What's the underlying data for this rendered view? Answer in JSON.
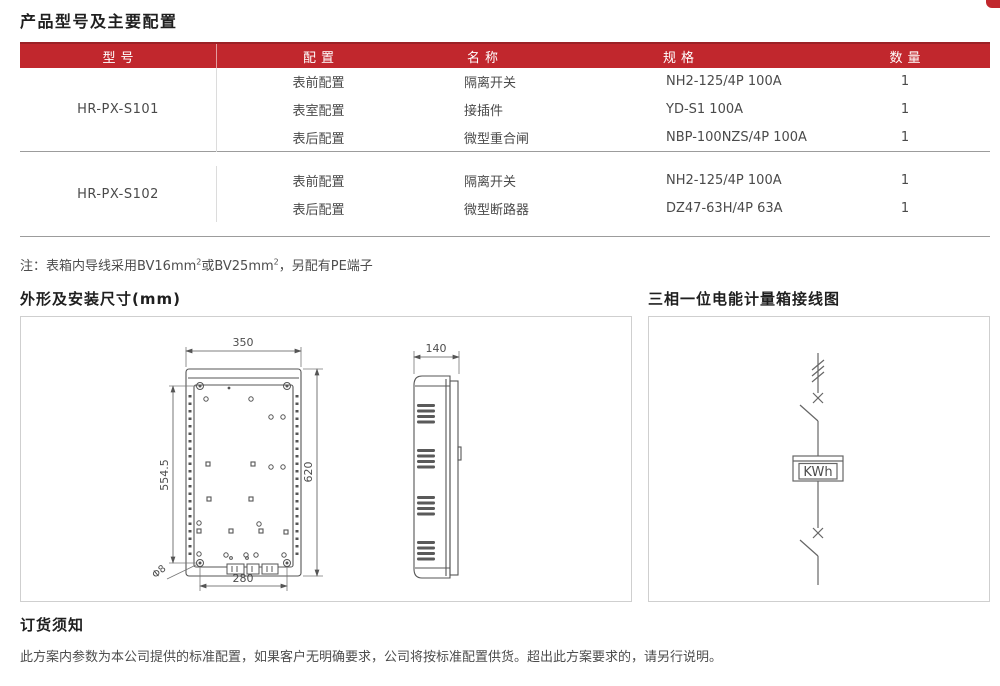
{
  "page": {
    "title": "产品型号及主要配置",
    "accent_color": "#c1272d"
  },
  "table": {
    "headers": [
      "型号",
      "配置",
      "名称",
      "规格",
      "数量"
    ],
    "groups": [
      {
        "model": "HR-PX-S101",
        "rows": [
          {
            "config": "表前配置",
            "name": "隔离开关",
            "spec": "NH2-125/4P 100A",
            "qty": "1"
          },
          {
            "config": "表室配置",
            "name": "接插件",
            "spec": "YD-S1 100A",
            "qty": "1"
          },
          {
            "config": "表后配置",
            "name": "微型重合闸",
            "spec": "NBP-100NZS/4P 100A",
            "qty": "1"
          }
        ]
      },
      {
        "model": "HR-PX-S102",
        "rows": [
          {
            "config": "表前配置",
            "name": "隔离开关",
            "spec": "NH2-125/4P 100A",
            "qty": "1"
          },
          {
            "config": "表后配置",
            "name": "微型断路器",
            "spec": "DZ47-63H/4P 63A",
            "qty": "1"
          }
        ]
      }
    ]
  },
  "note": {
    "part1": "注：表箱内导线采用BV16mm",
    "sup1": "2",
    "part2": "或BV25mm",
    "sup2": "2",
    "part3": "，另配有PE端子"
  },
  "sections": {
    "dimensions_title": "外形及安装尺寸(mm)",
    "wiring_title": "三相一位电能计量箱接线图"
  },
  "drawing": {
    "front_width": "350",
    "front_height": "620",
    "mount_height": "554.5",
    "mount_width": "280",
    "hole_dia": "Φ8",
    "side_depth": "140"
  },
  "wiring": {
    "meter_label": "KWh"
  },
  "footer": {
    "title": "订货须知",
    "text": "此方案内参数为本公司提供的标准配置，如果客户无明确要求，公司将按标准配置供货。超出此方案要求的，请另行说明。"
  }
}
